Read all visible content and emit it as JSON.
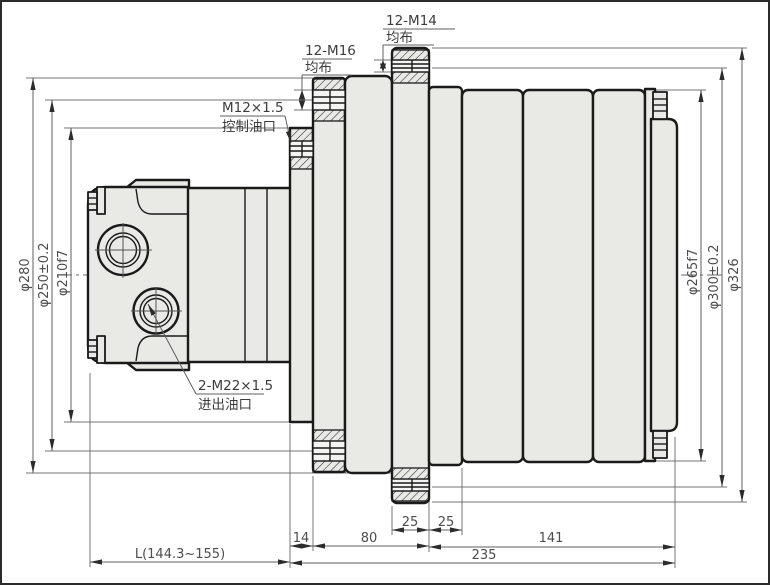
{
  "drawing_labels": {
    "bolts_m14": {
      "line1": "12-M14",
      "line2": "均布"
    },
    "bolts_m16": {
      "line1": "12-M16",
      "line2": "均布"
    },
    "control_port": {
      "line1": "M12×1.5",
      "line2": "控制油口"
    },
    "main_ports": {
      "line1": "2-M22×1.5",
      "line2": "进出油口"
    }
  },
  "dims": {
    "left": {
      "d1": "φ280",
      "d2": "φ250±0.2",
      "d3": "φ210f7"
    },
    "right": {
      "d1": "φ265f7",
      "d2": "φ300±0.2",
      "d3": "φ326"
    },
    "bottom": {
      "w14": "14",
      "w80": "80",
      "w25a": "25",
      "w25b": "25",
      "w141": "141",
      "w235": "235",
      "length": "L(144.3~155)"
    }
  },
  "colors": {
    "part_fill": "#e9e9e6",
    "outline": "#1a1a1a",
    "dim_line": "#6b6b6b",
    "dim_text": "#4d4d4d",
    "background": "#ffffff"
  }
}
